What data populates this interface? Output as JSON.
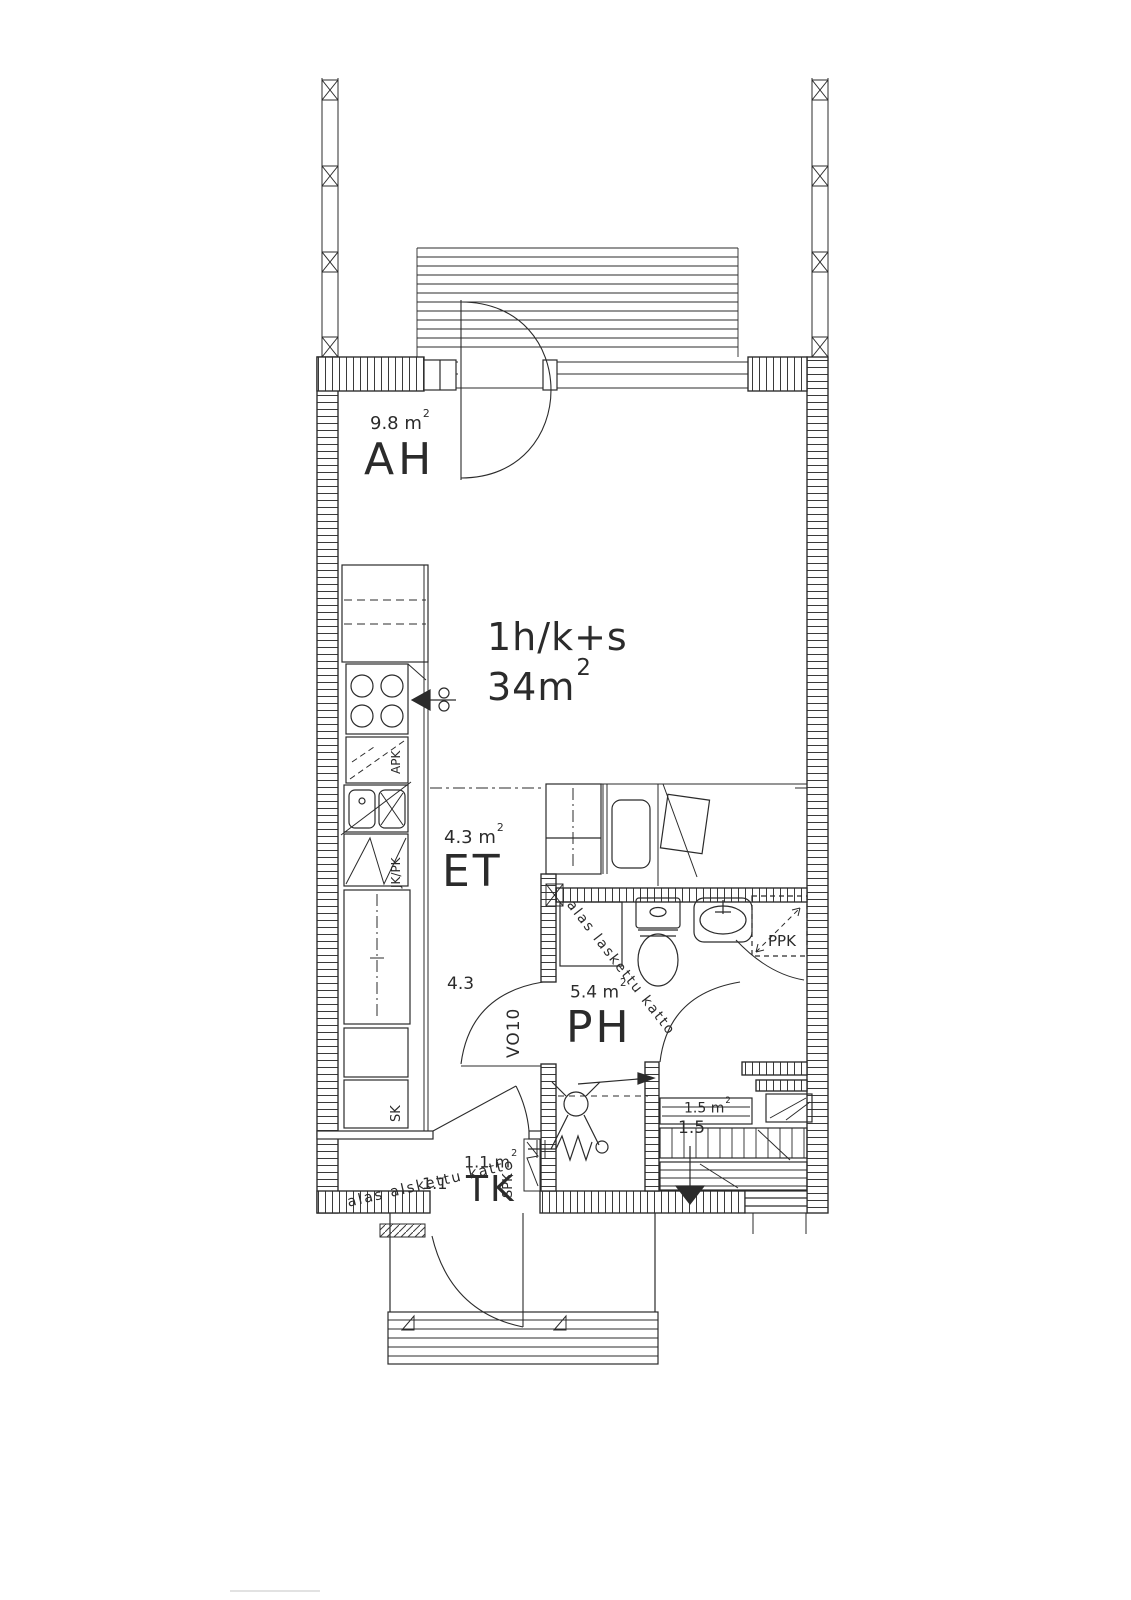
{
  "document": {
    "kind": "apartment floor plan (scanned architectural drawing)",
    "language": "Finnish"
  },
  "apartment": {
    "type": "1h/k+s",
    "area": "34m",
    "area_sup": "2"
  },
  "rooms": {
    "ah": {
      "label": "AH",
      "area": "9.8 m",
      "area_sup": "2"
    },
    "et": {
      "label": "ET",
      "area": "4.3 m",
      "area_sup": "2"
    },
    "ph": {
      "label": "PH",
      "area": "5.4 m",
      "area_sup": "2"
    },
    "tk": {
      "label": "TK",
      "area": "1.1 m",
      "area_sup": "2"
    },
    "sauna": {
      "area": "1.5 m",
      "area_sup": "2",
      "dim": "1.5"
    }
  },
  "labels": {
    "vo10": "VO10",
    "apk": "APK",
    "jkpk": "JK/PK",
    "sk": "SK",
    "spk": "SPK",
    "ppk": "PPK"
  },
  "annotations": {
    "ceiling_ph": "alas laskettu katto",
    "ceiling_tk": "alas alskettu katto",
    "dim_et": "4.3",
    "dim_tk": "1.1"
  },
  "fixtures": [
    "stove",
    "cooker-hood-arrow",
    "dishwasher-reservation",
    "sink",
    "fridge-freezer",
    "cleaning-cupboard",
    "toilet",
    "washbasin",
    "washing-machine-reservation",
    "shower",
    "sauna-benches",
    "sauna-heater",
    "balcony-deck",
    "balcony-railing",
    "entrance-steps"
  ],
  "colors": {
    "ink": "#2b2b2b",
    "paper": "#ffffff"
  }
}
